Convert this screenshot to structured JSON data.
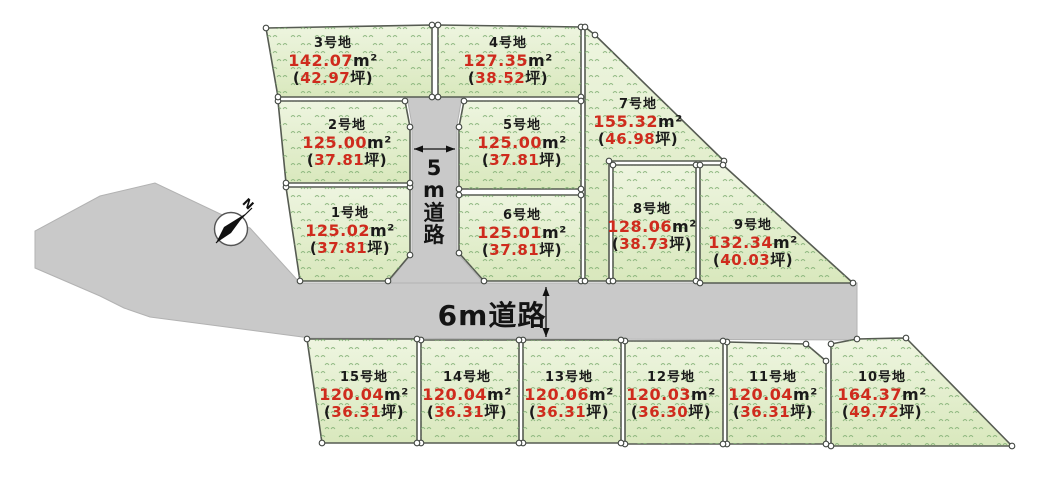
{
  "title": "分譲地区画図",
  "colors": {
    "accent_red": "#cf2b1d",
    "lot_fill_light": "#eef5e0",
    "lot_fill_dark": "#d9e8bd",
    "grass_mark": "#7fae72",
    "road_fill": "#c9c9c9",
    "lot_outline": "#565b52",
    "text_black": "#1a1a1a"
  },
  "units": {
    "sqm": "m²",
    "open": "(",
    "tsubo_close": "坪)"
  },
  "roads": {
    "road5m": {
      "label": "5m道路"
    },
    "road6m": {
      "label": "6m道路"
    }
  },
  "compass": {
    "label": "N"
  },
  "lots": [
    {
      "name": "1号地",
      "area_sqm": "125.02",
      "area_tsubo": "37.81"
    },
    {
      "name": "2号地",
      "area_sqm": "125.00",
      "area_tsubo": "37.81"
    },
    {
      "name": "3号地",
      "area_sqm": "142.07",
      "area_tsubo": "42.97"
    },
    {
      "name": "4号地",
      "area_sqm": "127.35",
      "area_tsubo": "38.52"
    },
    {
      "name": "5号地",
      "area_sqm": "125.00",
      "area_tsubo": "37.81"
    },
    {
      "name": "6号地",
      "area_sqm": "125.01",
      "area_tsubo": "37.81"
    },
    {
      "name": "7号地",
      "area_sqm": "155.32",
      "area_tsubo": "46.98"
    },
    {
      "name": "8号地",
      "area_sqm": "128.06",
      "area_tsubo": "38.73"
    },
    {
      "name": "9号地",
      "area_sqm": "132.34",
      "area_tsubo": "40.03"
    },
    {
      "name": "10号地",
      "area_sqm": "164.37",
      "area_tsubo": "49.72"
    },
    {
      "name": "11号地",
      "area_sqm": "120.04",
      "area_tsubo": "36.31"
    },
    {
      "name": "12号地",
      "area_sqm": "120.03",
      "area_tsubo": "36.30"
    },
    {
      "name": "13号地",
      "area_sqm": "120.06",
      "area_tsubo": "36.31"
    },
    {
      "name": "14号地",
      "area_sqm": "120.04",
      "area_tsubo": "36.31"
    },
    {
      "name": "15号地",
      "area_sqm": "120.04",
      "area_tsubo": "36.31"
    }
  ]
}
